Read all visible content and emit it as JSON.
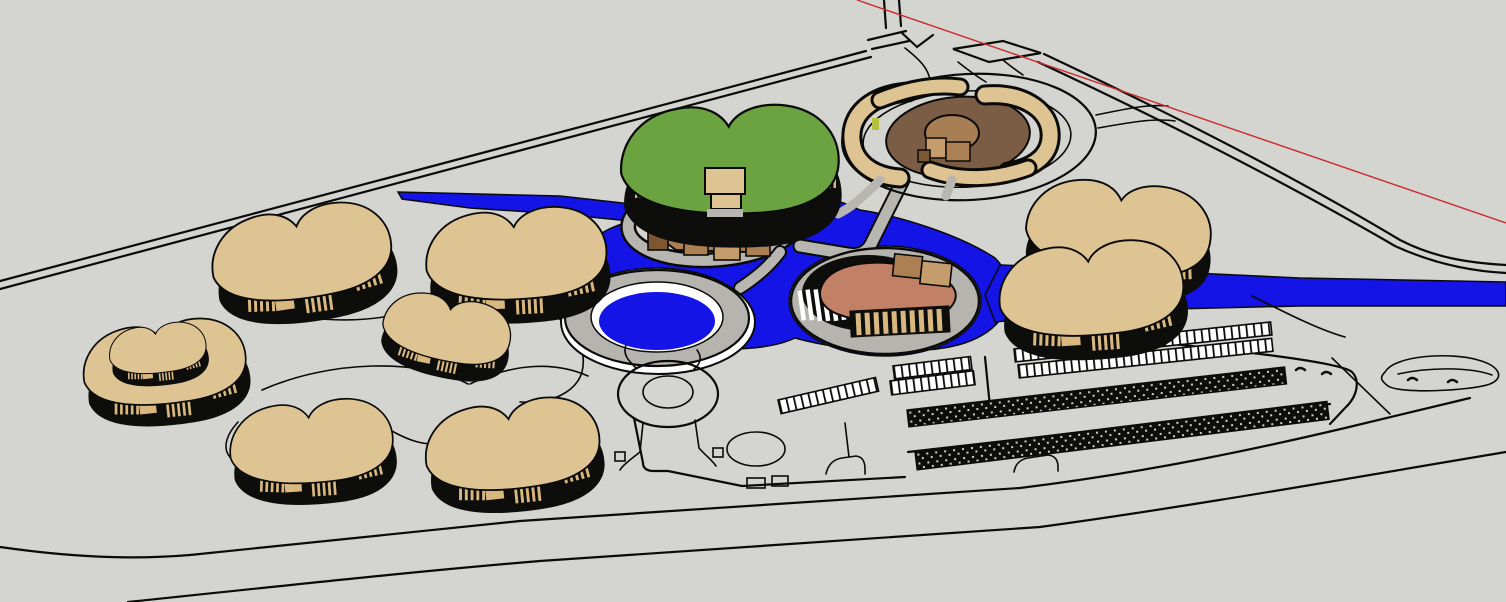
{
  "scene": {
    "title": "3D site model viewport",
    "description": "SketchUp-style aerial rendering of a resort master plan: kidney-shaped tan buildings with dark glazed walls, a green-roof hall, a central pavilion cluster, an oval island building in a blue river, a circular pool, a walled courtyard compound, parking rows and perimeter roads.",
    "colors": {
      "background": "#d4d4d0",
      "ground": "#d4d4d0",
      "outline": "#0a0a0a",
      "water": "#1414e6",
      "roof_tan": "#dfc493",
      "stripe_tan": "#d8b87f",
      "wall_dark": "#0d0d0c",
      "roof_green": "#6ca341",
      "box_brown": "#ad8054",
      "box_brown_light": "#c59c6c",
      "box_brown_dark": "#7d5731",
      "courtyard_brown": "#7b5c44",
      "dome_brown": "#a87e55",
      "roof_salmon": "#c28166",
      "road_gray": "#b7b6b0",
      "bridge_gray": "#aeada7",
      "ring_gray": "#b5b4ae",
      "pool_white": "#ffffff",
      "axis_red": "#cc2a2a"
    },
    "objects": [
      {
        "name": "ground-plane",
        "label": "Ground plane"
      },
      {
        "name": "perimeter-road-north",
        "label": "Straight perimeter road (upper left)"
      },
      {
        "name": "perimeter-road-east",
        "label": "Perimeter road to lower right"
      },
      {
        "name": "road-junction",
        "label": "Road junction with traffic island"
      },
      {
        "name": "site-boundary",
        "label": "Site boundary street (bottom)"
      },
      {
        "name": "river",
        "label": "River / water feature"
      },
      {
        "name": "circular-pool",
        "label": "Circular sunken pool"
      },
      {
        "name": "roundabout",
        "label": "Roundabout"
      },
      {
        "name": "pavilion-cluster",
        "label": "Central pavilion cluster on platform"
      },
      {
        "name": "island-building",
        "label": "Oval island building with salmon roof"
      },
      {
        "name": "green-roof-building",
        "label": "Green-roof hall"
      },
      {
        "name": "courtyard-compound",
        "label": "Walled courtyard compound with dome"
      },
      {
        "name": "kidney-building",
        "label": "Kidney-shaped residential building (x8)"
      },
      {
        "name": "parking-rows",
        "label": "Parking stall rows and hatched strips"
      },
      {
        "name": "red-axis-line",
        "label": "Red drawing axis line"
      }
    ]
  }
}
